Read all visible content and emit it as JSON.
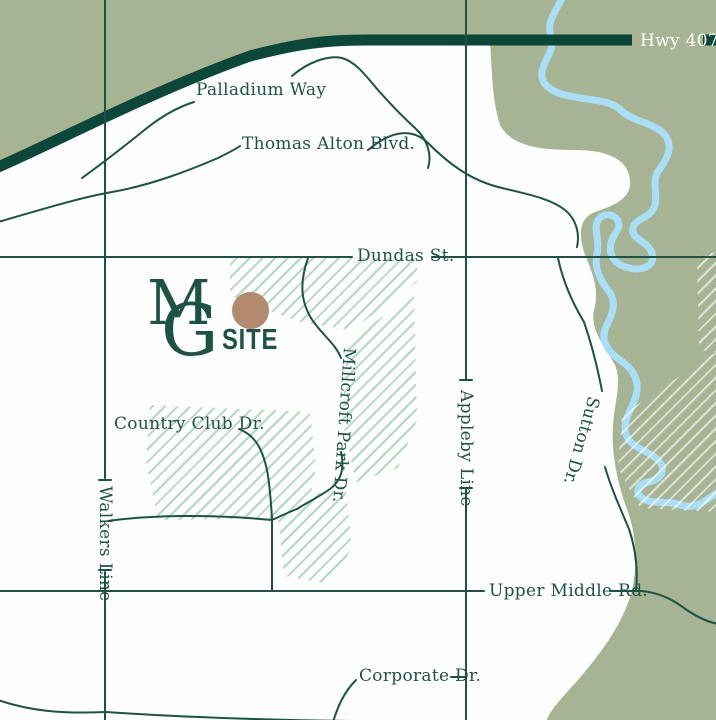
{
  "map": {
    "description": "Stylized site-location map",
    "labels": {
      "hwy407": "Hwy 407",
      "palladium_way": "Palladium Way",
      "thomas_alton": "Thomas Alton Blvd.",
      "dundas": "Dundas St.",
      "country_club": "Country Club Dr.",
      "walkers_line": "Walkers Line",
      "appleby_line": "Appleby Line",
      "millcroft_park": "Millcroft Park Dr.",
      "sutton": "Sutton Dr.",
      "upper_middle": "Upper Middle Rd.",
      "corporate": "Corporate Dr."
    },
    "logo": {
      "letter_m": "M",
      "letter_g": "G",
      "site_label": "SITE"
    },
    "colors": {
      "background": "#fdfefd",
      "greenspace_fill": "#a6b494",
      "highway_band": "#0c4839",
      "road_and_text": "#1d5345",
      "river": "#a9def7",
      "hatch_green": "#b0dabf",
      "site_marker_brown": "#b28a6f",
      "hwy_label_text": "#ffffff"
    }
  }
}
